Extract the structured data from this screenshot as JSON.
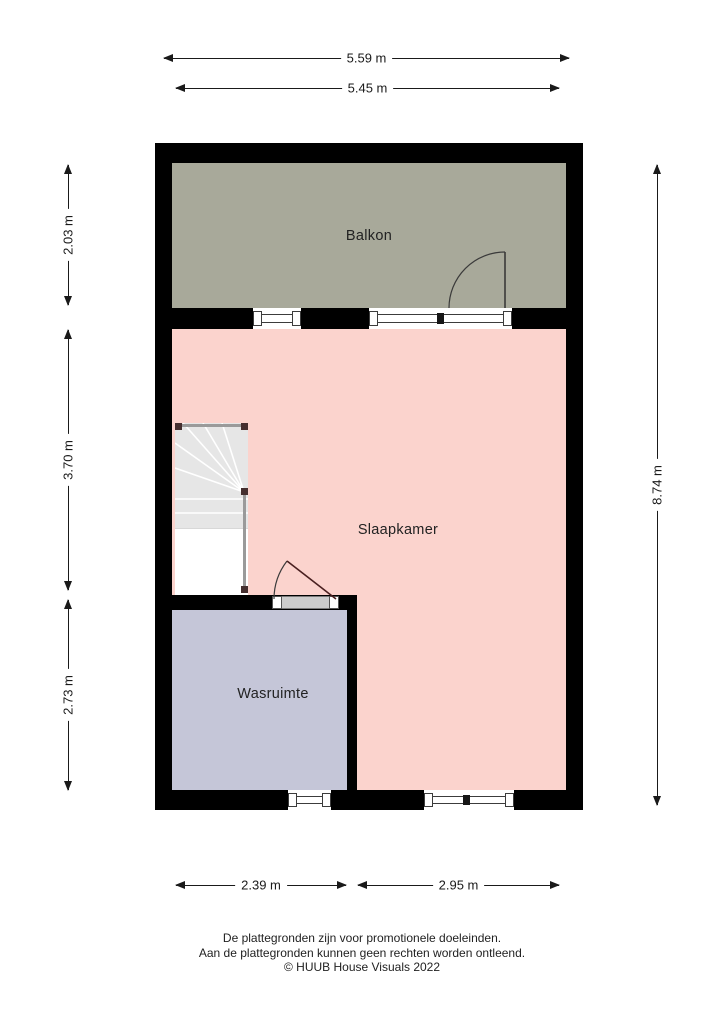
{
  "plan": {
    "type": "floor-plan",
    "rooms": {
      "balkon": {
        "label": "Balkon",
        "color": "#a8a99a"
      },
      "slaapkamer": {
        "label": "Slaapkamer",
        "color": "#fbd3cd"
      },
      "wasruimte": {
        "label": "Wasruimte",
        "color": "#c5c6d8"
      }
    },
    "features": {
      "stairs": "winder-staircase",
      "doors": [
        "balkon-door",
        "wasruimte-door"
      ],
      "window_count": 4
    }
  },
  "dimensions": {
    "top_outer": "5.59 m",
    "top_inner": "5.45 m",
    "left_balkon": "2.03 m",
    "left_middle": "3.70 m",
    "left_bottom": "2.73 m",
    "right_total": "8.74 m",
    "bottom_left": "2.39 m",
    "bottom_right": "2.95 m"
  },
  "colors": {
    "wall": "#000000",
    "background": "#ffffff",
    "dimension_line": "#1a1a1a",
    "stair_tread": "#e6e6e6",
    "railing": "#9a9a9a"
  },
  "footer": {
    "line1": "De plattegronden zijn voor promotionele doeleinden.",
    "line2": "Aan de plattegronden kunnen geen rechten worden ontleend.",
    "line3": "© HUUB House Visuals 2022"
  }
}
